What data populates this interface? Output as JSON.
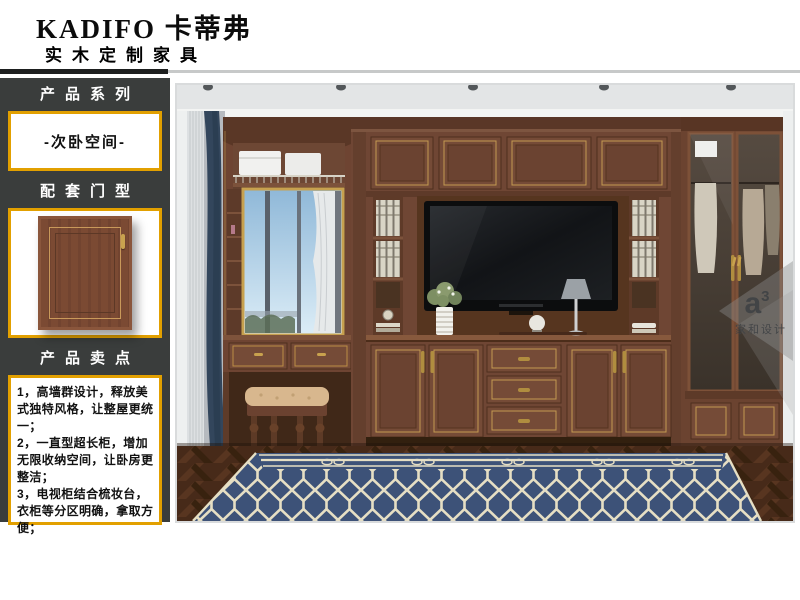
{
  "header": {
    "brand": "KADIFO 卡蒂弗",
    "subtitle": "实木定制家具"
  },
  "sidebar": {
    "series": {
      "title": "产品系列",
      "value": "-次卧空间-"
    },
    "door": {
      "title": "配套门型"
    },
    "selling": {
      "title": "产品卖点",
      "points": [
        "1，高墙群设计，释放美式独特风格，让整屋更统一；",
        "2，一直型超长柜，增加无限收纳空间，让卧房更整洁；",
        "3，电视柜结合梳妆台，衣柜等分区明确，拿取方便；"
      ]
    }
  },
  "photo": {
    "watermark": {
      "logo": "a",
      "sup": "3",
      "caption": "家和设计"
    },
    "colors": {
      "accent_gold": "#e2a000",
      "sidebar_bg": "#3a3d3c",
      "wood": "#6f4634",
      "wood_dark": "#5a3727",
      "rug_navy": "#3d5278",
      "rug_cream": "#e6dfc4",
      "floor": "#46291a",
      "ceiling": "#e3e5e6"
    }
  }
}
